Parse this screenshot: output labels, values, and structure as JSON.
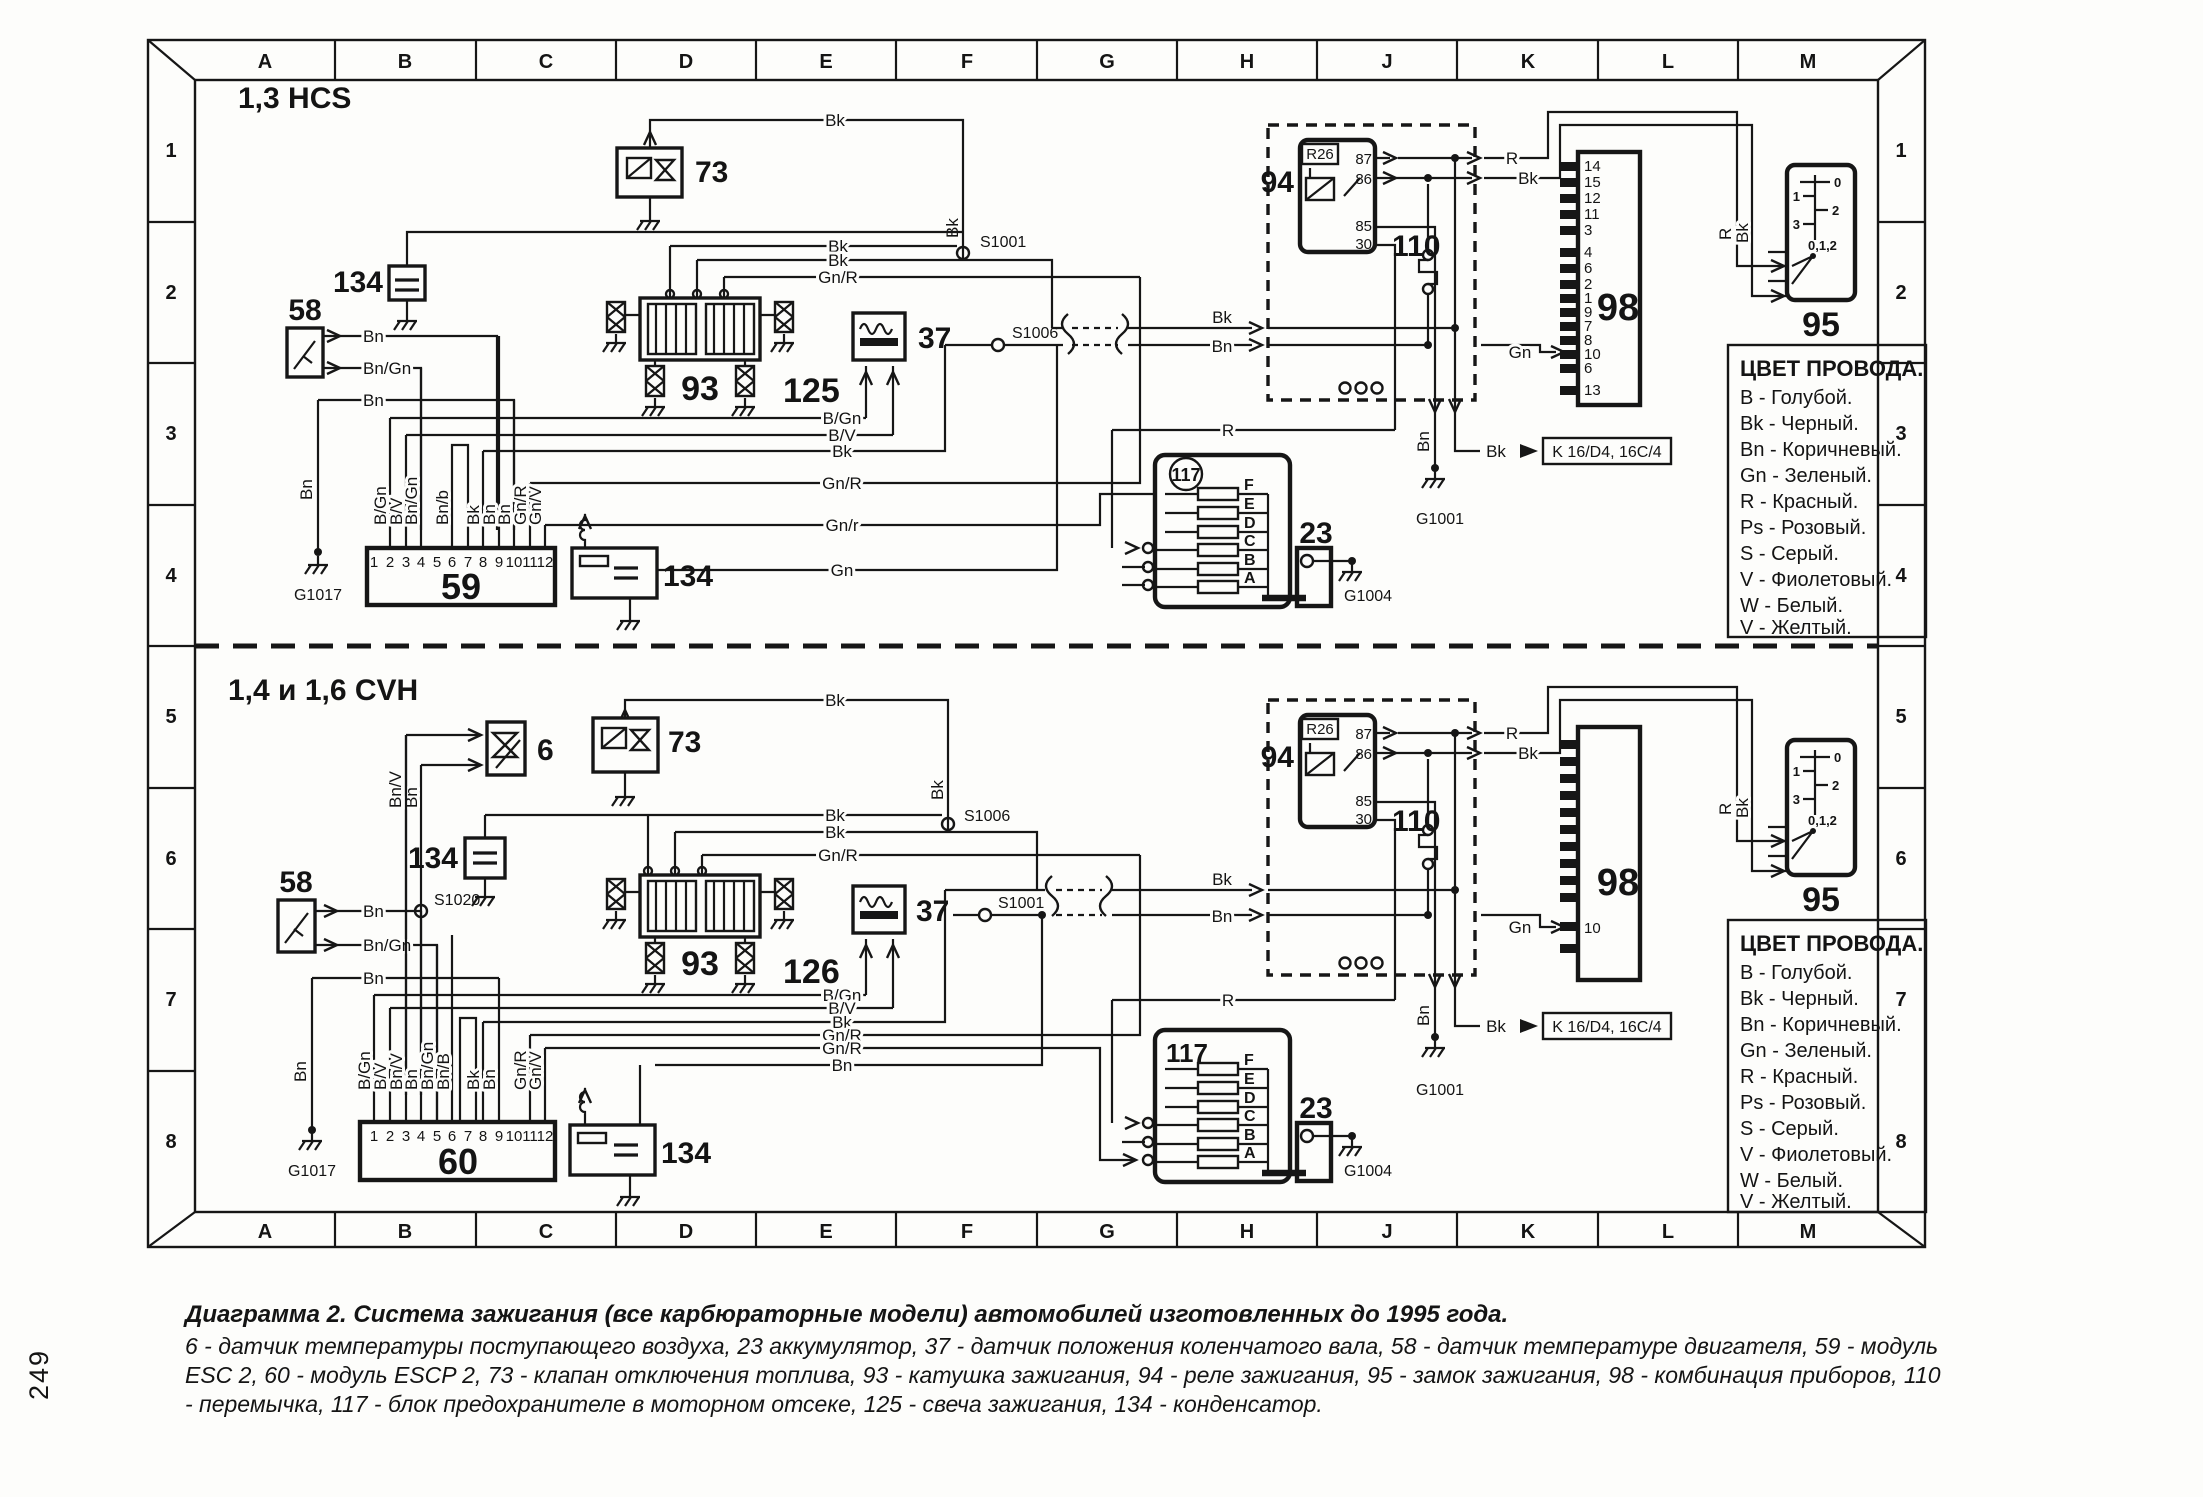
{
  "page_number": "249",
  "frame": {
    "columns": [
      "A",
      "B",
      "C",
      "D",
      "E",
      "F",
      "G",
      "H",
      "J",
      "K",
      "L",
      "M"
    ],
    "rows": [
      "1",
      "2",
      "3",
      "4",
      "5",
      "6",
      "7",
      "8"
    ]
  },
  "sections": {
    "top_title": "1,3 HCS",
    "bottom_title": "1,4 и 1,6 CVH"
  },
  "wires": {
    "b_gn": "B/Gn",
    "b_v": "B/V",
    "bk": "Bk",
    "bn": "Bn",
    "bn_gn": "Bn/Gn",
    "bn_b_lower": "Bn/b",
    "bn_b_upper": "Bn/B",
    "bn_v": "Bn/V",
    "gn": "Gn",
    "gn_r": "Gn/R",
    "gn_r_lower": "Gn/r",
    "gn_v": "Gn/V",
    "r": "R"
  },
  "components": {
    "c6": "6",
    "c23": "23",
    "c37": "37",
    "c58": "58",
    "c59": "59",
    "c60": "60",
    "c73": "73",
    "c93": "93",
    "c94": "94",
    "c95": "95",
    "c98": "98",
    "c110": "110",
    "c117": "117",
    "c125": "125",
    "c126": "126",
    "c134": "134",
    "relay_tag": "R26"
  },
  "pins": {
    "relay": [
      "87",
      "86",
      "85",
      "30"
    ],
    "module": [
      "1",
      "2",
      "3",
      "4",
      "5",
      "6",
      "7",
      "8",
      "9",
      "10",
      "11",
      "12"
    ],
    "cluster_top": [
      "14",
      "15",
      "12",
      "11",
      "3",
      "4",
      "6",
      "2",
      "1",
      "9",
      "7",
      "8",
      "10",
      "6",
      "13"
    ],
    "cluster_bottom_10": "10",
    "fuses": [
      "F",
      "E",
      "D",
      "C",
      "B",
      "A"
    ],
    "switch": [
      "0",
      "1",
      "2",
      "3"
    ],
    "switch_range": "0,1,2"
  },
  "grounds": {
    "g1017": "G1017",
    "g1001": "G1001",
    "g1004": "G1004"
  },
  "junctions": {
    "s1001": "S1001",
    "s1006": "S1006",
    "s1020": "S1020"
  },
  "ref_k": "K 16/D4, 16C/4",
  "legend": {
    "title": "ЦВЕТ ПРОВОДА.",
    "entries": [
      "В - Голубой.",
      "Bk - Черный.",
      "Bn - Коричневый.",
      "Gn - Зеленый.",
      "R - Красный.",
      "Ps - Розовый.",
      "S - Серый.",
      "V - Фиолетовый.",
      "W - Белый.",
      "V - Желтый."
    ]
  },
  "caption": {
    "line1": "Диаграмма 2. Система зажигания (все карбюраторные модели) автомобилей изготовленных до 1995 года.",
    "line2": "6 - датчик температуры поступающего воздуха, 23 аккумулятор, 37 - датчик положения коленчатого вала, 58 - датчик температуре двигателя, 59 - модуль",
    "line3": "ESC 2, 60 - модуль ESCP 2, 73 - клапан отключения топлива, 93 - катушка зажигания, 94 - реле зажигания, 95 - замок зажигания, 98 - комбинация приборов, 110",
    "line4": "- перемычка, 117 - блок предохранителе в моторном отсеке, 125 - свеча зажигания, 134 - конденсатор."
  }
}
